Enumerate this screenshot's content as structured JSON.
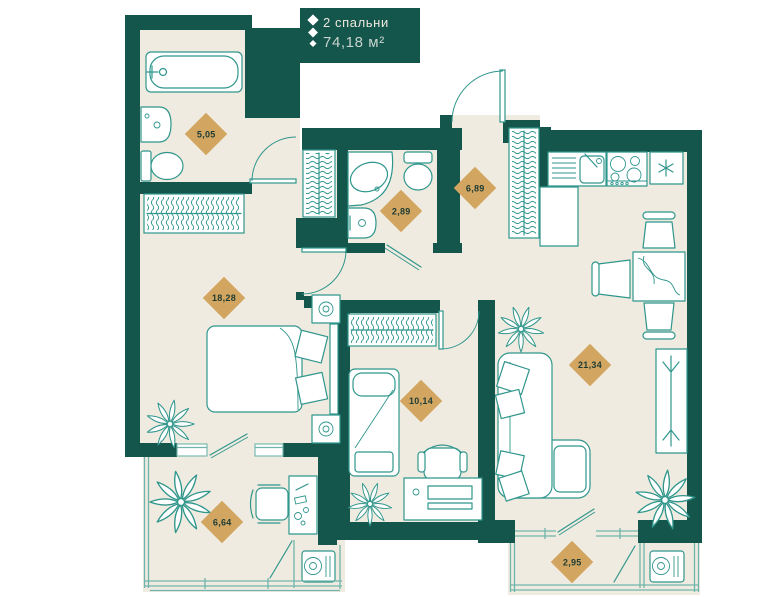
{
  "badge": {
    "icon": "diamond-column-icon",
    "bedrooms_label": "2 спальни",
    "total_area": "74,18 м²"
  },
  "area_unit": "м²",
  "rooms": [
    {
      "name": "bathroom",
      "area": "5,05",
      "fixtures": [
        "bathtub",
        "sink",
        "toilet"
      ]
    },
    {
      "name": "wc",
      "area": "2,89",
      "fixtures": [
        "corner-bathtub",
        "toilet",
        "sink"
      ]
    },
    {
      "name": "hallway",
      "area": "6,89",
      "fixtures": [
        "entrance-door",
        "wardrobe"
      ]
    },
    {
      "name": "bedroom",
      "area": "18,28",
      "fixtures": [
        "wardrobe",
        "double-bed",
        "nightstands",
        "plant"
      ]
    },
    {
      "name": "bedroom-2",
      "area": "10,14",
      "fixtures": [
        "wardrobe",
        "single-bed",
        "desk",
        "chair",
        "plant"
      ]
    },
    {
      "name": "kitchen-living-room",
      "area": "21,34",
      "fixtures": [
        "kitchen-sink",
        "stove",
        "fridge",
        "dining-table",
        "chairs",
        "sofa",
        "coat-rack",
        "plants"
      ]
    },
    {
      "name": "loggia",
      "area": "6,64",
      "fixtures": [
        "plant",
        "chair",
        "desk",
        "ac-unit"
      ]
    },
    {
      "name": "balcony",
      "area": "2,95",
      "fixtures": [
        "ac-unit"
      ]
    }
  ],
  "colors": {
    "wall": "#14554c",
    "floor": "#f0ebe0",
    "furniture_line": "#2f968c",
    "glazing_line": "#6fb5ab",
    "area_diamond": "#d2a660",
    "area_text": "#1d3b35",
    "badge_bg": "#14554c",
    "badge_text": "#ece8dc",
    "badge_area_text": "#c7d4ce",
    "canvas": "#ffffff"
  }
}
